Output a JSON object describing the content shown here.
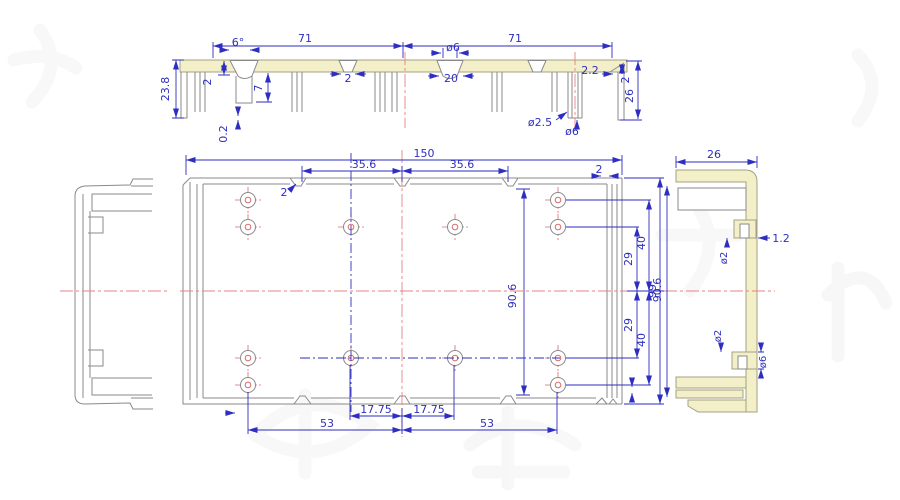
{
  "drawing": {
    "kind": "CAD engineering drawing - extruded enclosure profile, three orthographic views",
    "colors": {
      "dimension_blue": "#2e2ec0",
      "outline_gray": "#8a8a8a",
      "section_fill_yellow": "#f3efc9",
      "centerline_red": "#e88080",
      "background": "#ffffff"
    },
    "views": {
      "top_section": {
        "label": "top section view",
        "dims": {
          "length_left": "71",
          "length_right": "71",
          "angle": "6°",
          "lip_thickness": "2",
          "height_left": "23.8",
          "channel_depth": "7",
          "gap": "0.2",
          "notch_width": "2",
          "slot_diameter": "ø6",
          "slot_width": "20",
          "wall_step": "2.2",
          "edge_thickness": "2",
          "height_right": "26",
          "hole_small": "ø2.5",
          "hole_large": "ø6"
        }
      },
      "front": {
        "label": "front view",
        "hole_count": 12,
        "dims": {
          "width": "150",
          "offset_left": "35.6",
          "offset_right": "35.6",
          "notch_depth": "2",
          "groove": "2",
          "inner_height": "90.6",
          "hole_row_upper": "40",
          "hole_row_upper_mid": "29",
          "overall_height": "99",
          "hole_row_lower_mid": "29",
          "hole_row_lower": "40",
          "hole_span_left": "53",
          "hole_mid_left": "17.75",
          "hole_mid_right": "17.75",
          "hole_span_right": "53"
        }
      },
      "left_side": {
        "label": "left side view (C-channel, no dimensions)"
      },
      "right_side": {
        "label": "right side view",
        "dims": {
          "depth": "26",
          "height": "90.6",
          "tab_hole": "ø2",
          "tab_offset": "1.2",
          "boss_hole": "ø2",
          "boss_slot": "ø6"
        }
      }
    }
  }
}
